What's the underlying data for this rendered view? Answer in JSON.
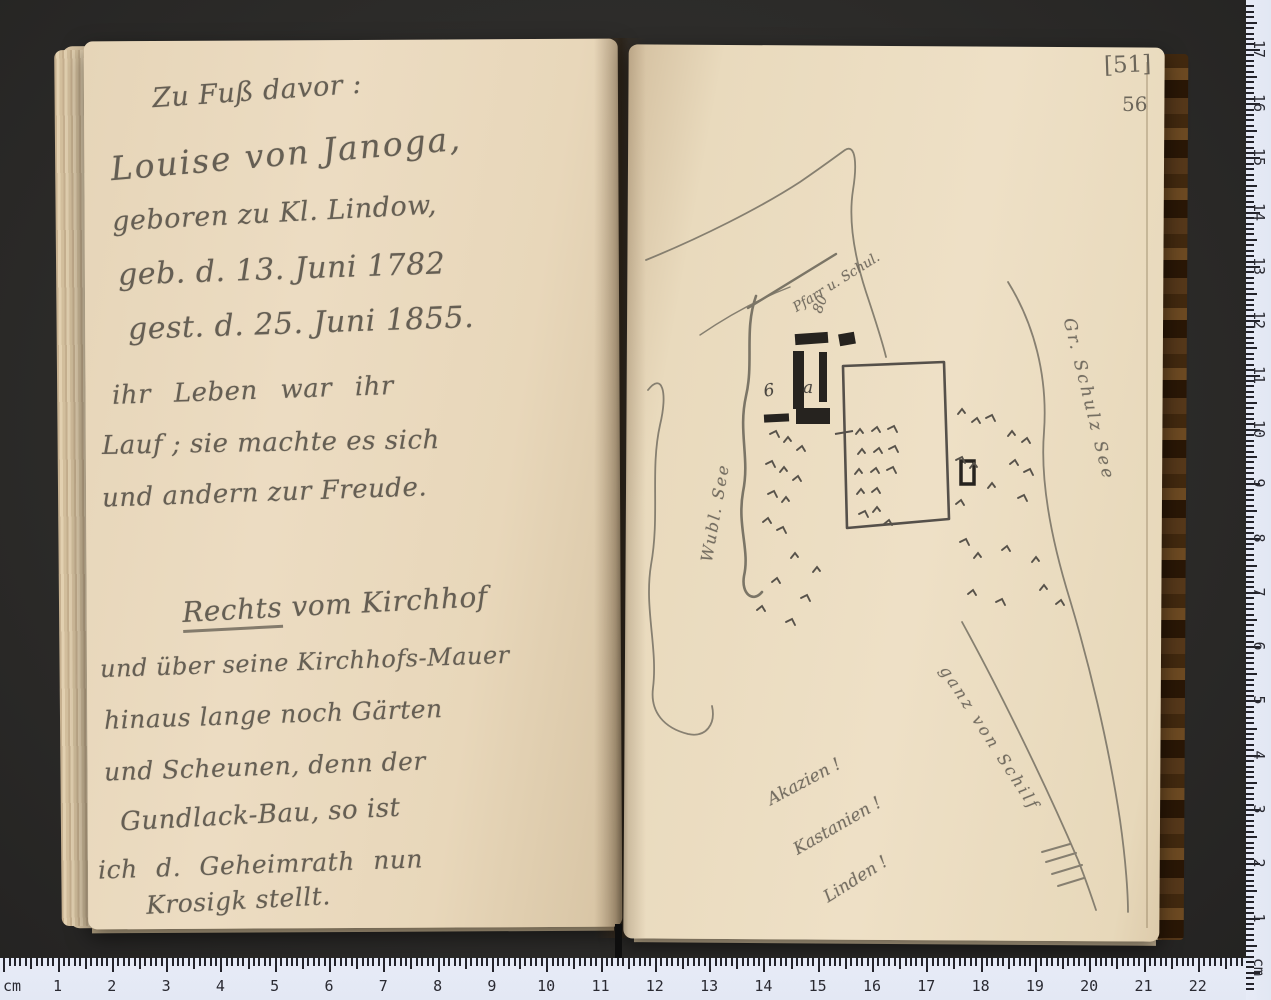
{
  "page_numbers": {
    "bracketed": "[51]",
    "plain": "56"
  },
  "left_page": {
    "lines": [
      {
        "text": "Zu Fuß davor :"
      },
      {
        "text": "Louise von Janoga,"
      },
      {
        "text": "geboren zu Kl. Lindow,"
      },
      {
        "text": "geb. d. 13. Juni 1782"
      },
      {
        "text": "gest. d. 25. Juni 1855."
      },
      {
        "text": "ihr Leben war ihr"
      },
      {
        "text": "Lauf ; sie machte es sich"
      },
      {
        "text": "und andern zur Freude."
      },
      {
        "underline": "Rechts",
        "rest": " vom Kirchhof"
      },
      {
        "text": "und über seine Kirchhofs-Mauer"
      },
      {
        "text": "hinaus lange noch Gärten"
      },
      {
        "text": "und Scheunen, denn der"
      },
      {
        "text": "Gundlack-Bau, so ist"
      },
      {
        "text": "ich d. Geheimrath nun"
      },
      {
        "text": "Krosigk stellt."
      }
    ]
  },
  "map": {
    "labels": {
      "pfarr_schule": "Pfarr u. Schul.",
      "number_80": "80",
      "letter_a": "a",
      "number_6": "6",
      "lake_left": "Wubl. See",
      "lake_right": "Gr. Schulz See",
      "reeds": "ganz von Schilf",
      "trees_1": "Akazien !",
      "trees_2": "Kastanien !",
      "trees_3": "Linden !"
    }
  },
  "rulers": {
    "bottom": {
      "unit_label": "cm",
      "numbers": [
        1,
        2,
        3,
        4,
        5,
        6,
        7,
        8,
        9,
        10,
        11,
        12,
        13,
        14,
        15,
        16,
        17,
        18,
        19,
        20,
        21,
        22
      ]
    },
    "right": {
      "unit_label": "cm",
      "numbers": [
        17,
        16,
        15,
        14,
        13,
        12,
        11,
        10,
        9,
        8,
        7,
        6,
        5,
        4,
        3,
        2,
        1
      ]
    }
  }
}
